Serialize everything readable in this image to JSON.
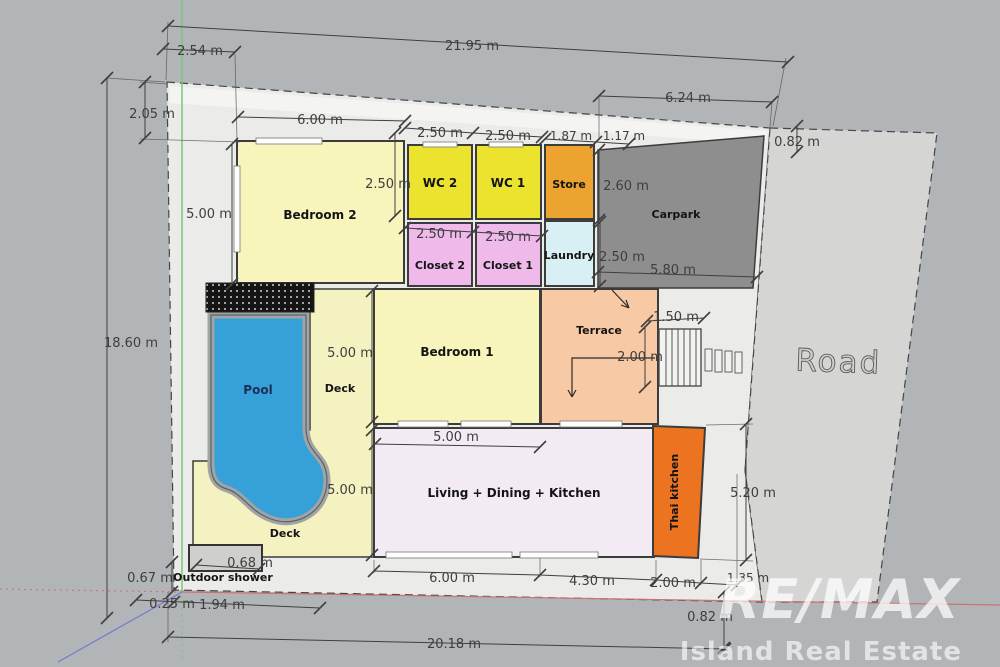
{
  "plan": {
    "type": "floor-plan",
    "units": "m",
    "rooms": [
      {
        "name": "Bedroom 2"
      },
      {
        "name": "WC 2"
      },
      {
        "name": "WC 1"
      },
      {
        "name": "Store"
      },
      {
        "name": "Carpark"
      },
      {
        "name": "Closet 2"
      },
      {
        "name": "Closet 1"
      },
      {
        "name": "Laundry"
      },
      {
        "name": "Terrace"
      },
      {
        "name": "Bedroom 1"
      },
      {
        "name": "Pool"
      },
      {
        "name": "Deck"
      },
      {
        "name": "Deck"
      },
      {
        "name": "Living + Dining + Kitchen"
      },
      {
        "name": "Thai kitchen"
      },
      {
        "name": "Outdoor shower"
      },
      {
        "name": "Road"
      }
    ],
    "dimensions": [
      {
        "label": "21.95 m"
      },
      {
        "label": "2.54 m"
      },
      {
        "label": "2.05 m"
      },
      {
        "label": "18.60 m"
      },
      {
        "label": "6.00 m"
      },
      {
        "label": "2.50 m"
      },
      {
        "label": "2.50 m"
      },
      {
        "label": "1.87 m"
      },
      {
        "label": "1.17 m"
      },
      {
        "label": "6.24 m"
      },
      {
        "label": "0.82 m"
      },
      {
        "label": "2.50 m"
      },
      {
        "label": "2.60 m"
      },
      {
        "label": "5.00 m"
      },
      {
        "label": "2.50 m"
      },
      {
        "label": "2.50 m"
      },
      {
        "label": "2.50 m"
      },
      {
        "label": "5.80 m"
      },
      {
        "label": "1.50 m"
      },
      {
        "label": "2.00 m"
      },
      {
        "label": "5.00 m"
      },
      {
        "label": "5.00 m"
      },
      {
        "label": "5.00 m"
      },
      {
        "label": "5.20 m"
      },
      {
        "label": "6.00 m"
      },
      {
        "label": "4.30 m"
      },
      {
        "label": "2.00 m"
      },
      {
        "label": "1.35 m"
      },
      {
        "label": "0.82 m"
      },
      {
        "label": "20.18 m"
      },
      {
        "label": "0.67 m"
      },
      {
        "label": "0.25 m"
      },
      {
        "label": "1.94 m"
      },
      {
        "label": "0.68 m"
      }
    ],
    "watermark": {
      "brand": "RE/MAX",
      "tagline": "Island Real Estate"
    },
    "colors": {
      "background": "#b2b5b8",
      "lot": "#ebebe9",
      "lot_strip": "#f4f4f2",
      "road": "#d5d6d4",
      "carpark": "#8e8e8e",
      "bedroom": "#f7f5bb",
      "wc": "#ece32f",
      "store": "#eca32f",
      "closet": "#efb9ea",
      "laundry": "#d8f0f4",
      "terrace": "#f7c9a4",
      "living": "#f2ebf4",
      "thai_kitchen": "#ec7421",
      "deck": "#f5f2c2",
      "pool_water": "#36a1d9",
      "pool_coping": "#a3a3a1",
      "stairs": "#f3f3f1",
      "outdoor_shower": "#cfcfcd",
      "wall": "#3c3c3c",
      "dimension_text": "#3e3e3e",
      "axis_green": "#79c879",
      "axis_red": "#cc7272",
      "axis_blue": "#7878cc",
      "watermark_white": "rgba(255,255,255,0.72)"
    }
  }
}
